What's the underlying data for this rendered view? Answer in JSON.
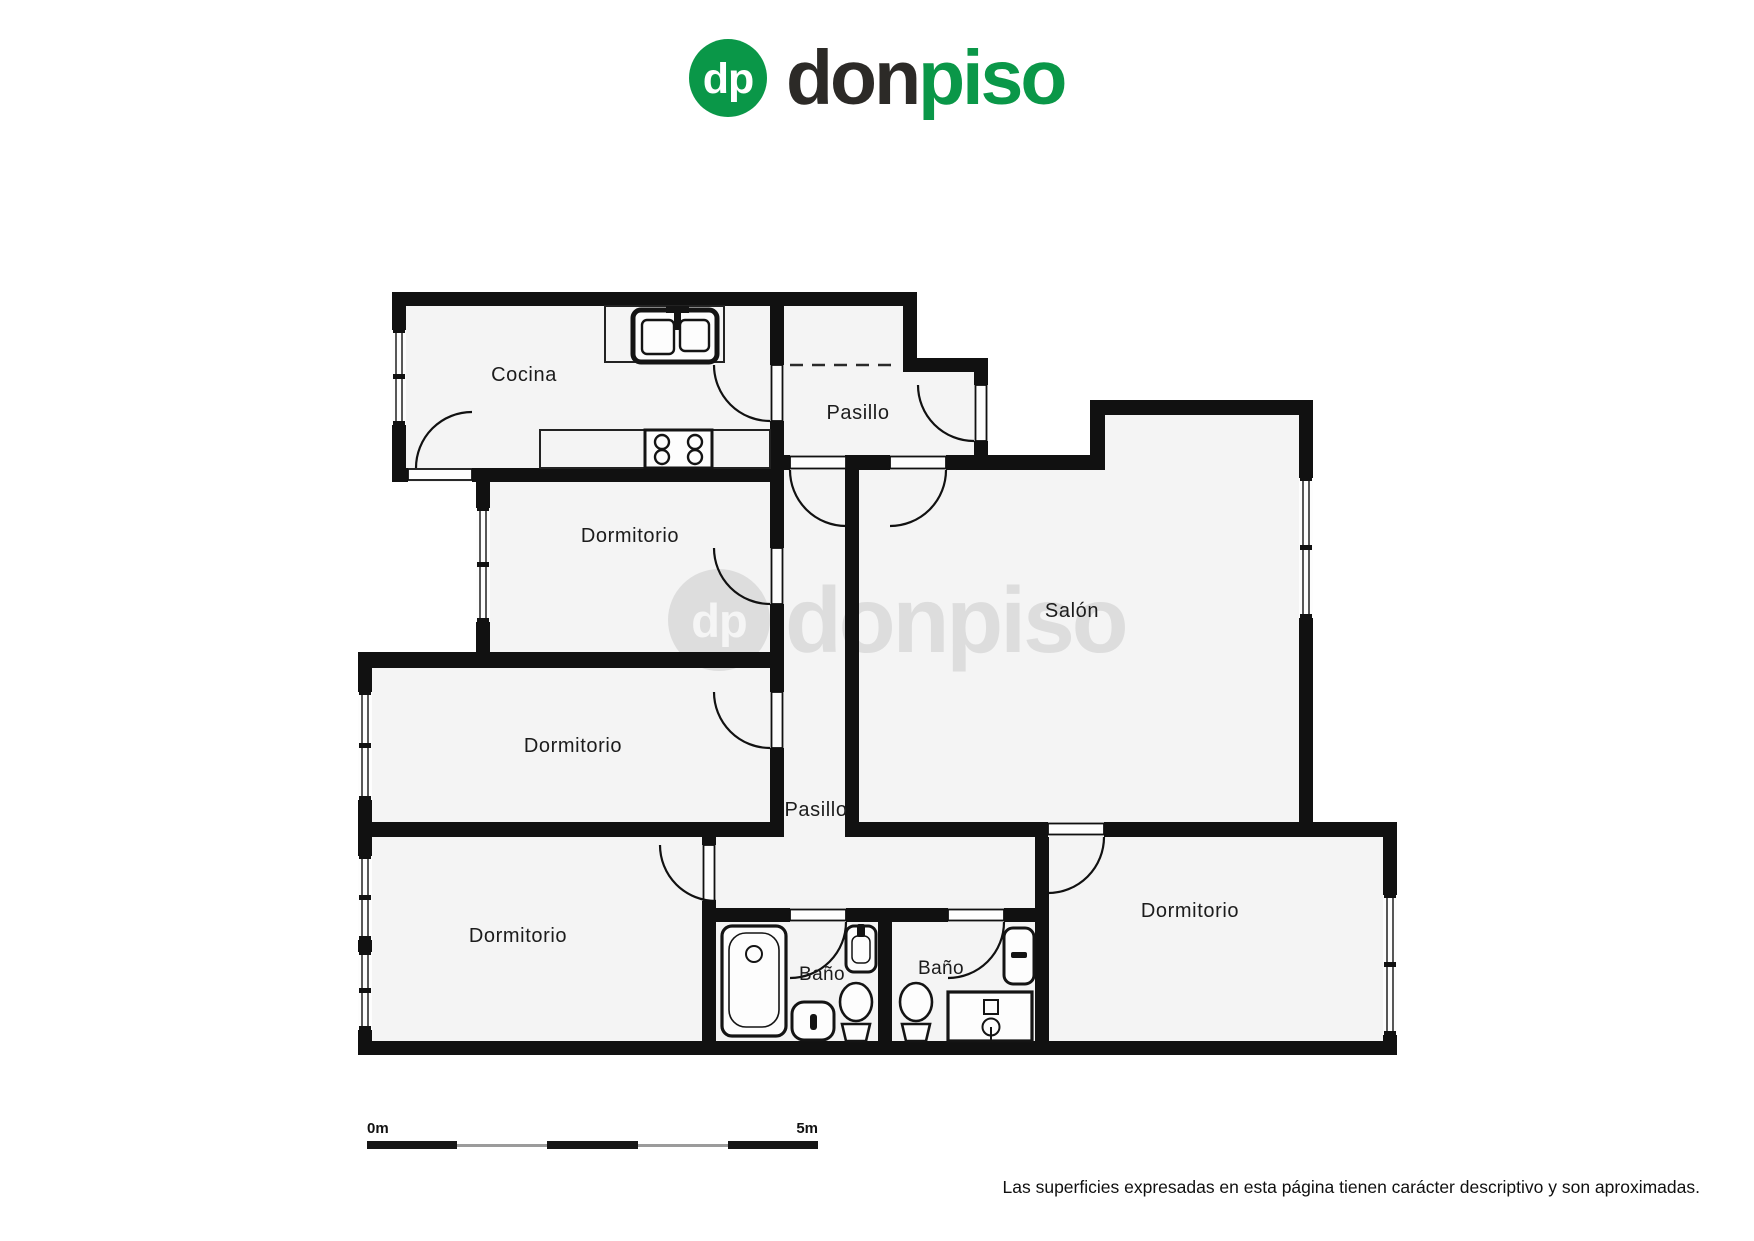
{
  "brand": {
    "monogram": "dp",
    "wordmark_don": "don",
    "wordmark_piso": "piso",
    "green": "#0a9748",
    "dark": "#2c2a27"
  },
  "watermark": {
    "monogram": "dp",
    "text": "donpiso"
  },
  "rooms": {
    "cocina": "Cocina",
    "pasillo_superior": "Pasillo",
    "dormitorio_1": "Dormitorio",
    "salon": "Salón",
    "dormitorio_2": "Dormitorio",
    "pasillo_inferior": "Pasillo",
    "dormitorio_3": "Dormitorio",
    "bano_1": "Baño",
    "bano_2": "Baño",
    "dormitorio_4": "Dormitorio"
  },
  "scale_bar": {
    "start": "0m",
    "end": "5m"
  },
  "footer": {
    "disclaimer": "Las superficies expresadas en esta página tienen carácter descriptivo y son aproximadas."
  }
}
